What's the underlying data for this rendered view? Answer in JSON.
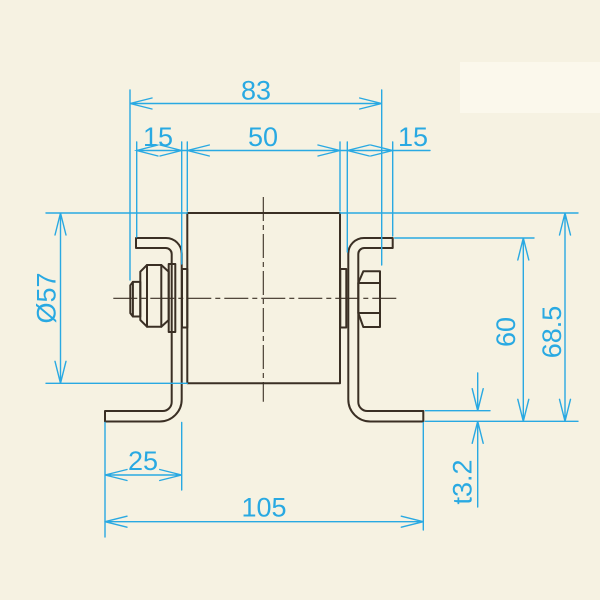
{
  "colors": {
    "background": "#f6f2e2",
    "paper_patch": "#fbf8ec",
    "outline": "#3a2f24",
    "dimension": "#29a9e2"
  },
  "dimensions": {
    "top_overall": {
      "label": "83"
    },
    "top_left_offset": {
      "label": "15"
    },
    "top_center": {
      "label": "50"
    },
    "top_right_offset": {
      "label": "15"
    },
    "roller_diameter": {
      "label": "Ø57"
    },
    "bracket_height": {
      "label": "60"
    },
    "overall_height": {
      "label": "68.5"
    },
    "plate_thickness": {
      "label": "t3.2"
    },
    "foot_length": {
      "label": "25"
    },
    "bottom_overall": {
      "label": "105"
    }
  }
}
